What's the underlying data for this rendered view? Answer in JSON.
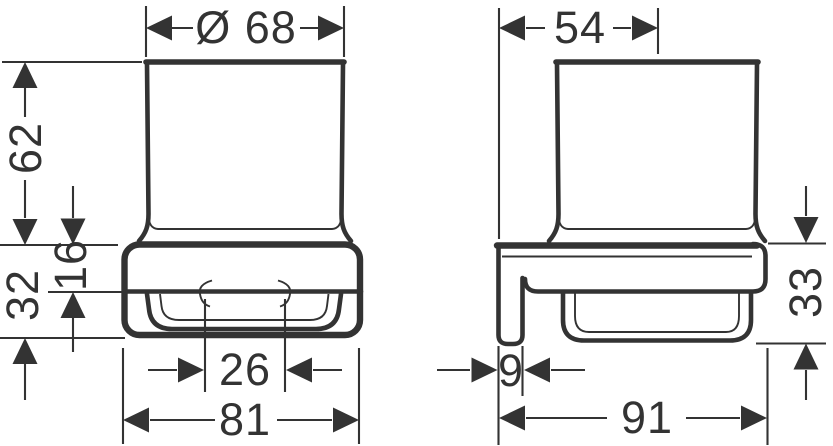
{
  "style": {
    "line_color": "#333333",
    "background": "#ffffff"
  },
  "views": {
    "front": {
      "dim_diameter": "Ø 68",
      "dim_glass_height": "62",
      "dim_holder_height": "32",
      "dim_collar_height": "16",
      "dim_inner_width": "26",
      "dim_overall_width": "81"
    },
    "side": {
      "dim_wall_to_center": "54",
      "dim_plate_thickness": "9",
      "dim_overall_depth": "91",
      "dim_holder_height": "33"
    }
  }
}
